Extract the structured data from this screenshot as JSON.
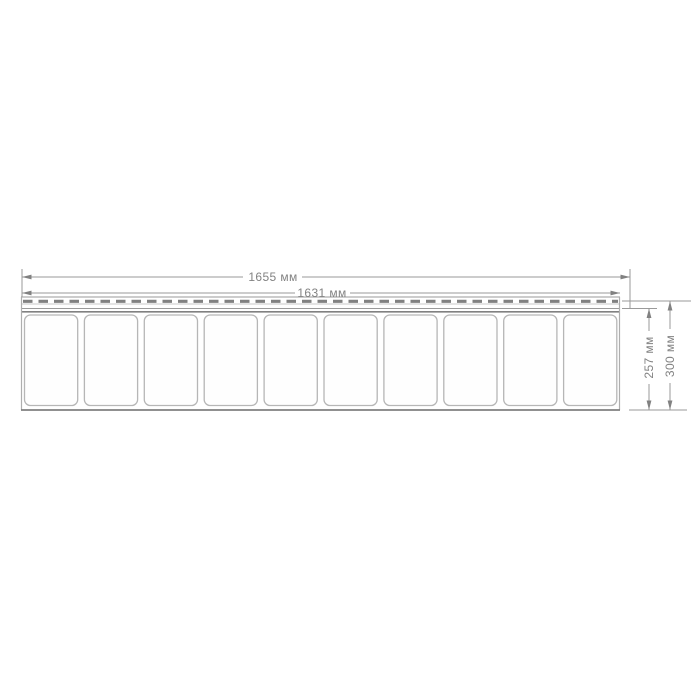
{
  "drawing": {
    "kind": "panel-dimension-diagram",
    "units": "мм",
    "panel": {
      "slat_count": 10,
      "has_nail_strip_slots": true
    },
    "dimensions": {
      "overall_width": {
        "label": "1655 мм",
        "value": 1655
      },
      "cover_width": {
        "label": "1631 мм",
        "value": 1631
      },
      "panel_height": {
        "label": "257 мм",
        "value": 257
      },
      "overall_height": {
        "label": "300 мм",
        "value": 300
      }
    },
    "colors": {
      "background": "#ffffff",
      "line": "#9a9a9a",
      "dark_line": "#818181",
      "text": "#828282",
      "panel_edge": "#aeaeae",
      "slat_border": "#b6b6b6"
    }
  }
}
